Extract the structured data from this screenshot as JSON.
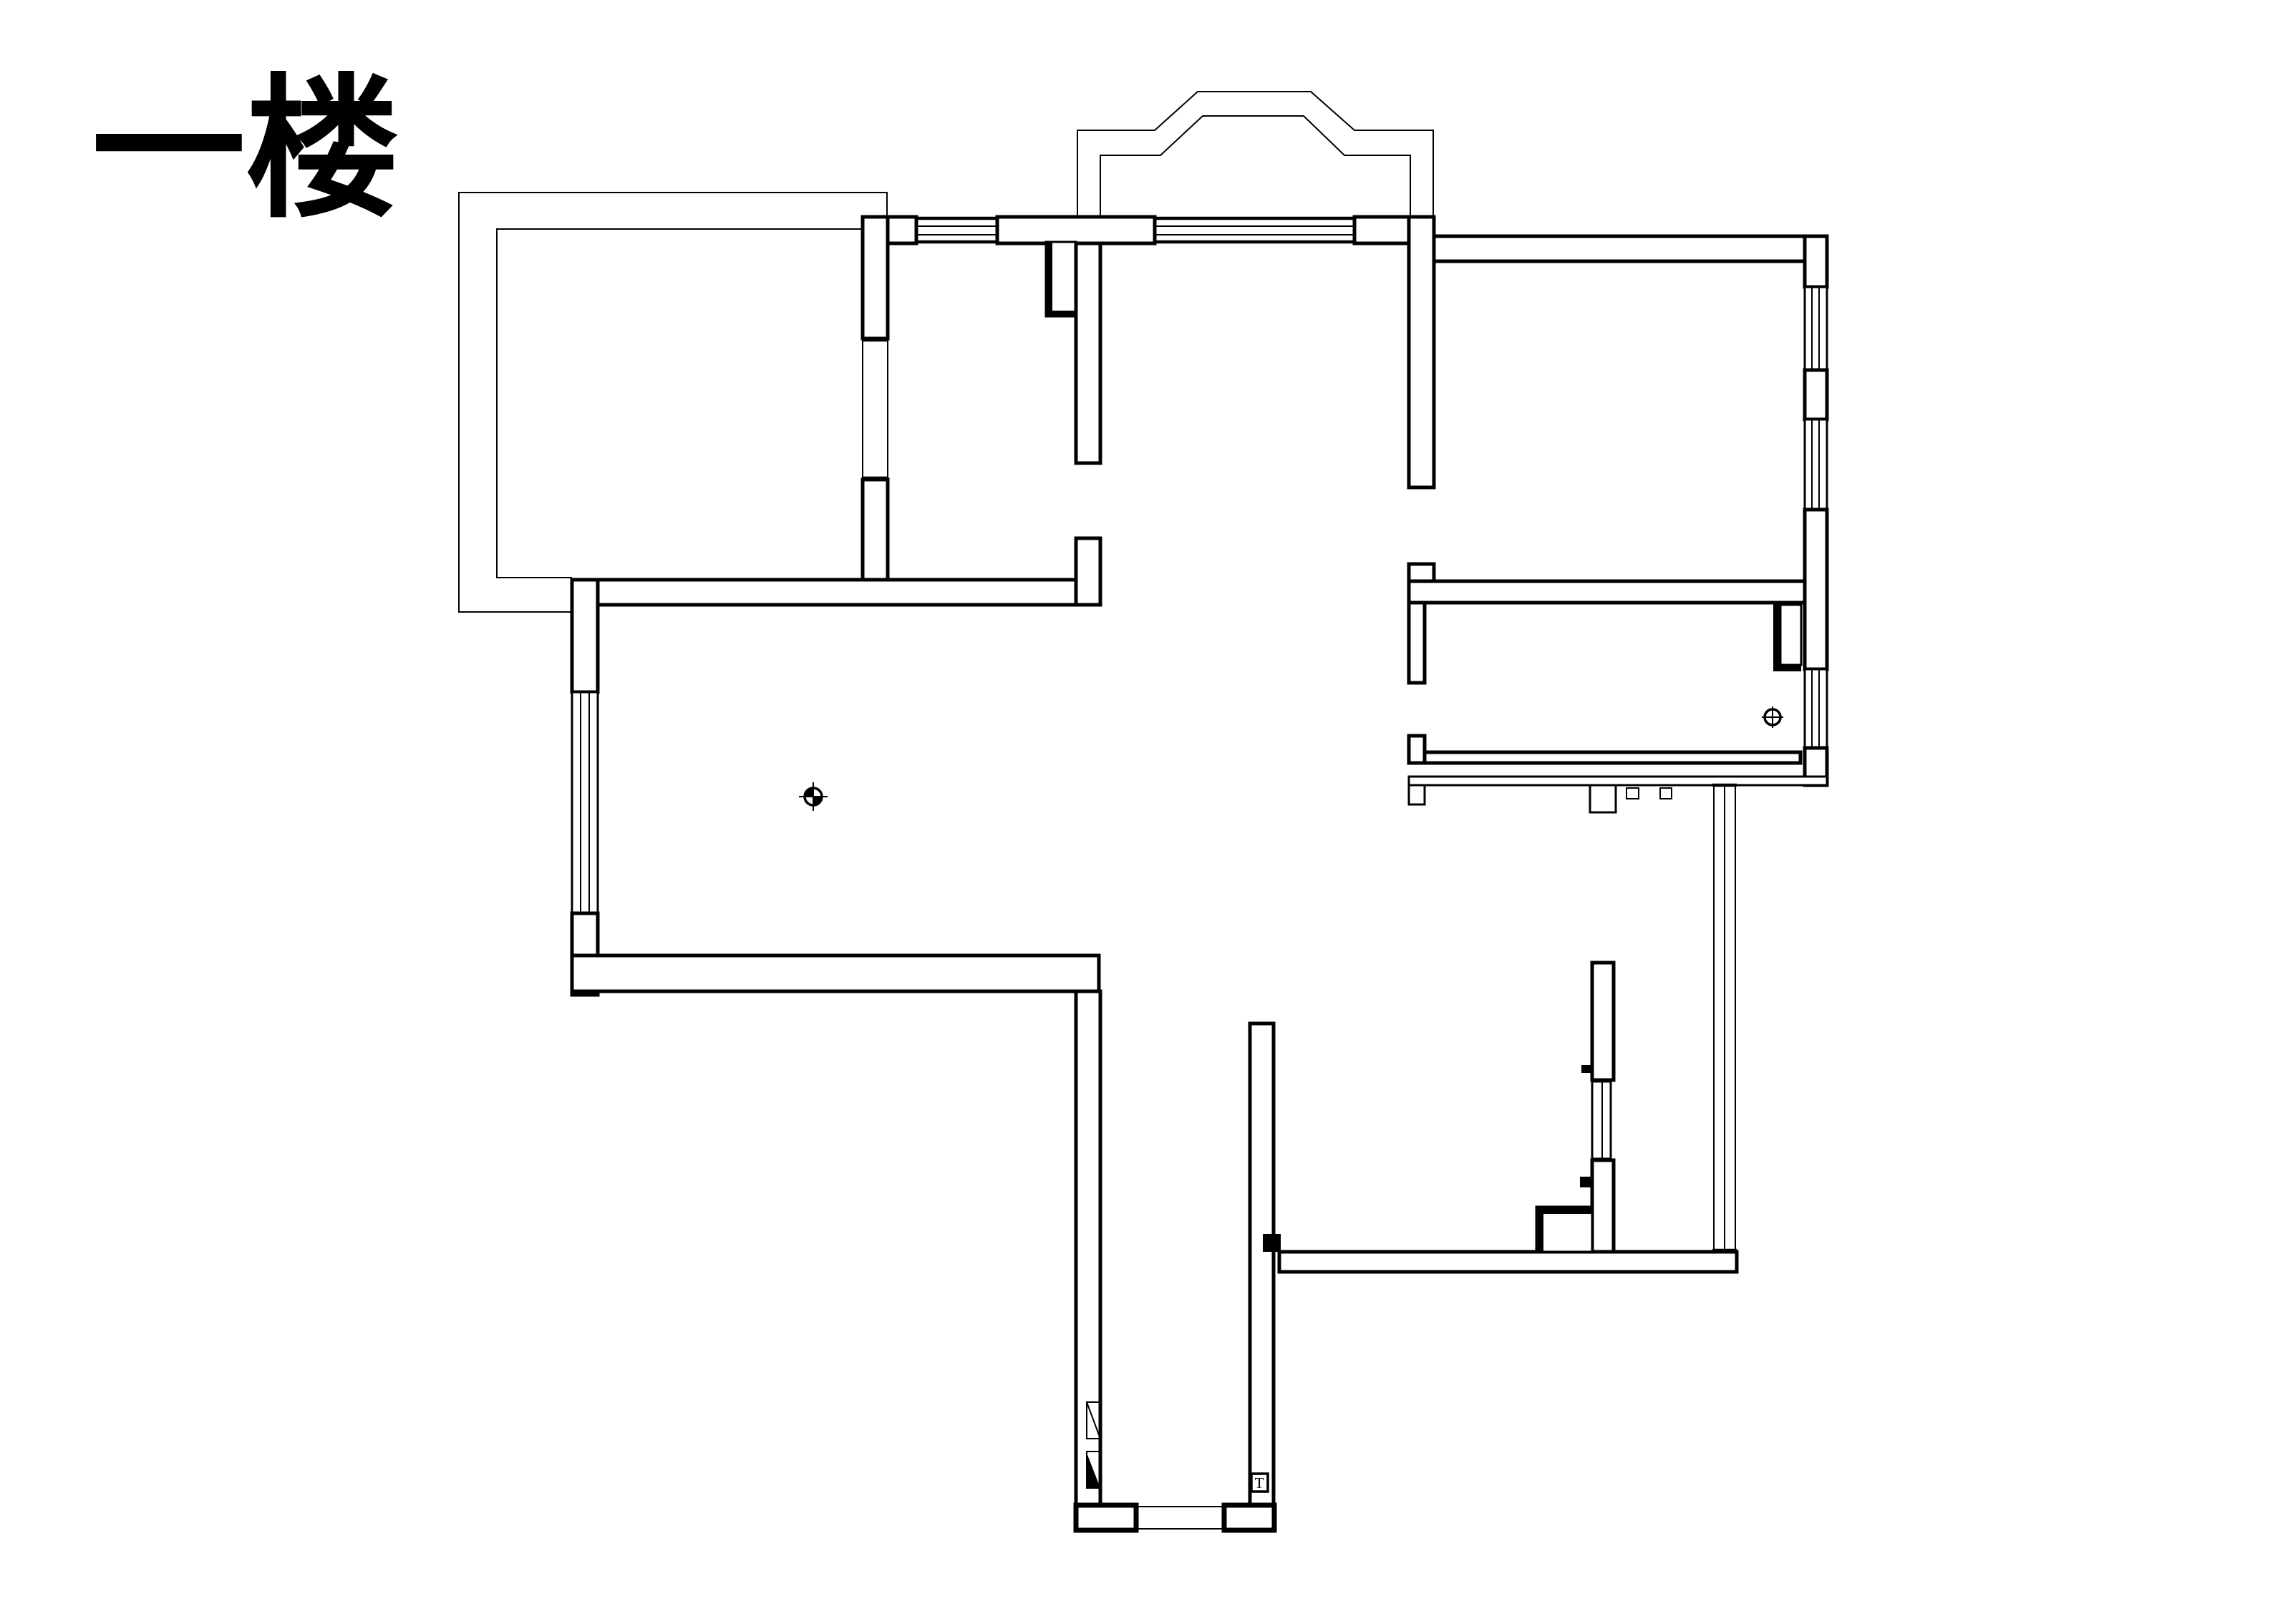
{
  "page": {
    "title": "一楼",
    "background": "#ffffff",
    "ink": "#000000"
  },
  "plan": {
    "entry_marker": "T",
    "icons": {
      "living_room_symbol": "quadrant-crosshair-icon",
      "dining_room_symbol": "circled-cross-icon",
      "entry_door_symbol": "door-leaf-triangles-icon"
    }
  }
}
